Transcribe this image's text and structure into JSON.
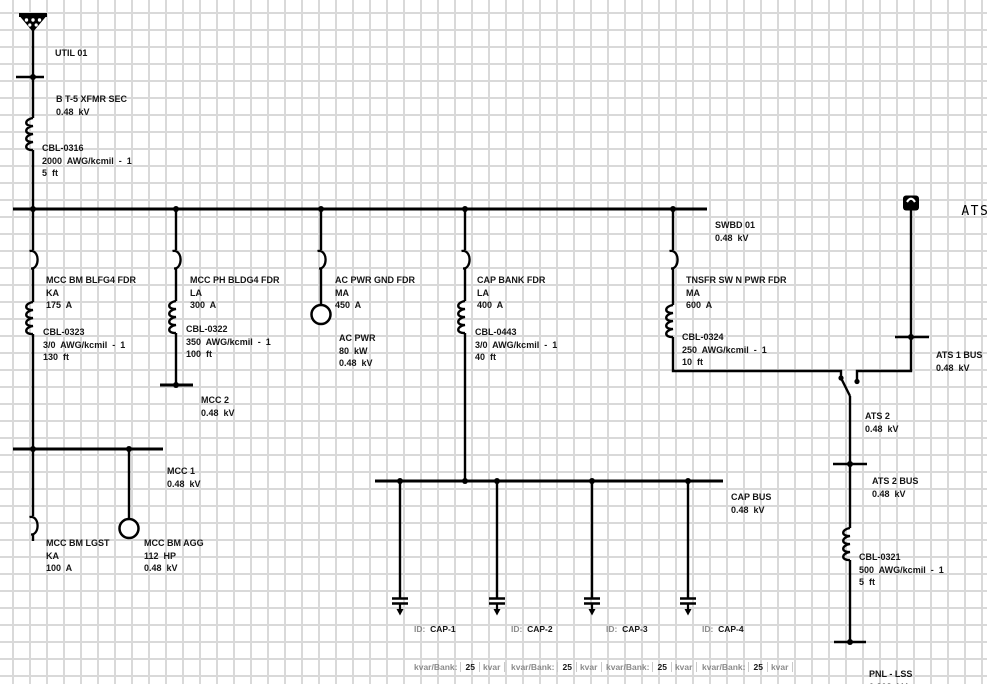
{
  "colors": {
    "line": "#000000",
    "grid": "#d9d9d9",
    "label_text": "#151515",
    "muted_text": "#8b8b8b"
  },
  "labels": {
    "util": "UTIL 01",
    "xfmr_sec": [
      "B T-5 XFMR SEC",
      "0.48  kV"
    ],
    "swbd01": [
      "SWBD 01",
      "0.48  kV"
    ],
    "feeders": [
      [
        "MCC BM BLFG4 FDR",
        "KA",
        "175  A"
      ],
      [
        "MCC PH BLDG4 FDR",
        "LA",
        "300  A"
      ],
      [
        "AC PWR GND FDR",
        "MA",
        "450  A"
      ],
      [
        "CAP BANK FDR",
        "LA",
        "400  A"
      ],
      [
        "TNSFR SW N PWR FDR",
        "MA",
        "600  A"
      ]
    ],
    "cables": {
      "cbl0316": [
        "CBL-0316",
        "2000  AWG/kcmil  -  1",
        "5  ft"
      ],
      "cbl0323": [
        "CBL-0323",
        "3/0  AWG/kcmil  -  1",
        "130  ft"
      ],
      "cbl0322": [
        "CBL-0322",
        "350  AWG/kcmil  -  1",
        "100  ft"
      ],
      "cbl0443": [
        "CBL-0443",
        "3/0  AWG/kcmil  -  1",
        "40  ft"
      ],
      "cbl0324": [
        "CBL-0324",
        "250  AWG/kcmil  -  1",
        "10  ft"
      ],
      "cbl0321": [
        "CBL-0321",
        "500  AWG/kcmil  -  1",
        "5  ft"
      ]
    },
    "ac_pwr": [
      "AC PWR",
      "80  kW",
      "0.48  kV"
    ],
    "mcc1": [
      "MCC 1",
      "0.48  kV"
    ],
    "mcc2": [
      "MCC 2",
      "0.48  kV"
    ],
    "mcc_bm_lgst": [
      "MCC BM LGST",
      "KA",
      "100  A"
    ],
    "mcc_bm_agg": [
      "MCC BM AGG",
      "112  HP",
      "0.48  kV"
    ],
    "ats1": "ATS 1",
    "ats1_bus": [
      "ATS 1 BUS",
      "0.48  kV"
    ],
    "ats2": [
      "ATS 2",
      "0.48  kV"
    ],
    "ats2_bus": [
      "ATS 2 BUS",
      "0.48  kV"
    ],
    "cap_bus": [
      "CAP BUS",
      "0.48  kV"
    ],
    "pnl_lss": [
      "PNL - LSS",
      "0.208  kV"
    ],
    "caps": [
      {
        "id_label": "ID:",
        "id": "CAP-1",
        "bank_label": "kvar/Bank:",
        "bank": "25",
        "unit": "kvar"
      },
      {
        "id_label": "ID:",
        "id": "CAP-2",
        "bank_label": "kvar/Bank:",
        "bank": "25",
        "unit": "kvar"
      },
      {
        "id_label": "ID:",
        "id": "CAP-3",
        "bank_label": "kvar/Bank:",
        "bank": "25",
        "unit": "kvar"
      },
      {
        "id_label": "ID:",
        "id": "CAP-4",
        "bank_label": "kvar/Bank:",
        "bank": "25",
        "unit": "kvar"
      }
    ]
  }
}
